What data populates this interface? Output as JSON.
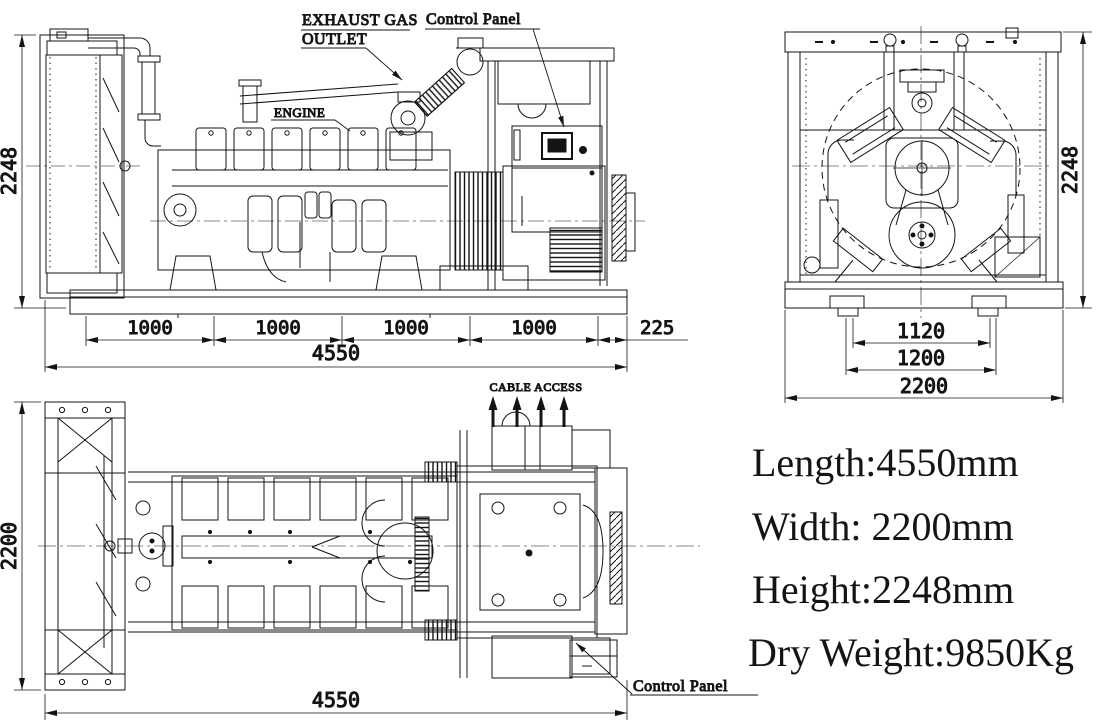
{
  "labels": {
    "exhaust_gas_line1": "EXHAUST GAS",
    "exhaust_gas_line2": "OUTLET",
    "control_panel_top": "Control Panel",
    "engine": "ENGINE",
    "cable_access": "CABLE ACCESS",
    "control_panel_plan": "Control Panel"
  },
  "dimensions": {
    "side": {
      "height": "2248",
      "bay": "1000",
      "overhang": "225",
      "total_length": "4550"
    },
    "front": {
      "height": "2248",
      "feet_inner": "1120",
      "feet_outer": "1200",
      "width": "2200"
    },
    "plan": {
      "width": "2200",
      "total_length": "4550"
    }
  },
  "specs": {
    "length": "Length:4550mm",
    "width": "Width: 2200mm",
    "height": "Height:2248mm",
    "dry_weight": "Dry Weight:9850Kg"
  },
  "colors": {
    "line": "#141414",
    "background": "#ffffff"
  }
}
